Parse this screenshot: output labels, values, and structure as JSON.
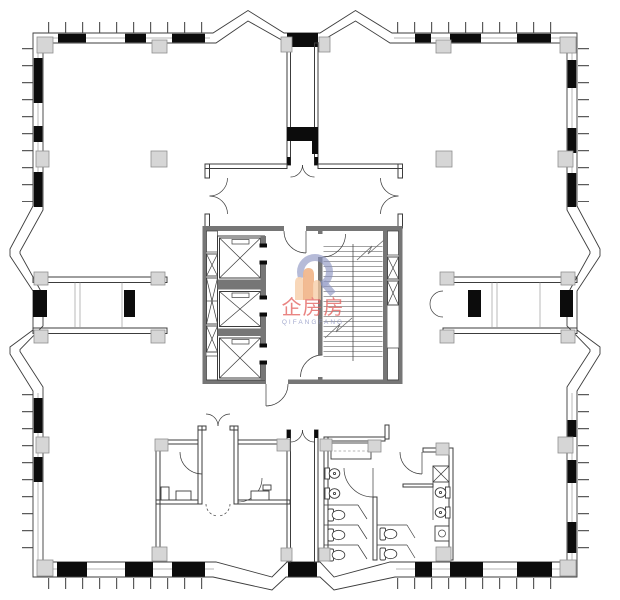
{
  "watermark": {
    "brand": "企房房",
    "subtext": "QIFANGFANG"
  },
  "palette": {
    "line": "#3c3c3c",
    "light": "#9c9c9c",
    "black": "#0c0c0c",
    "pad": "#d6d6d6",
    "pad_border": "#8f8f8f",
    "core": "#767676",
    "tread": "#a2a2a2",
    "wm_red": "#e4625f",
    "wm_blue": "#8b93c2",
    "wm_orange": "#eda36e",
    "wm_orange_light": "#f6c9a0"
  },
  "inventory": {
    "elevator_shafts": 3,
    "stair_flights": 2,
    "duct_shafts": 7,
    "toilet_stalls": 5,
    "wall_basins": 4,
    "vanity_counters": 1,
    "link_bridges": 2,
    "service_shafts_vertical": 2
  }
}
